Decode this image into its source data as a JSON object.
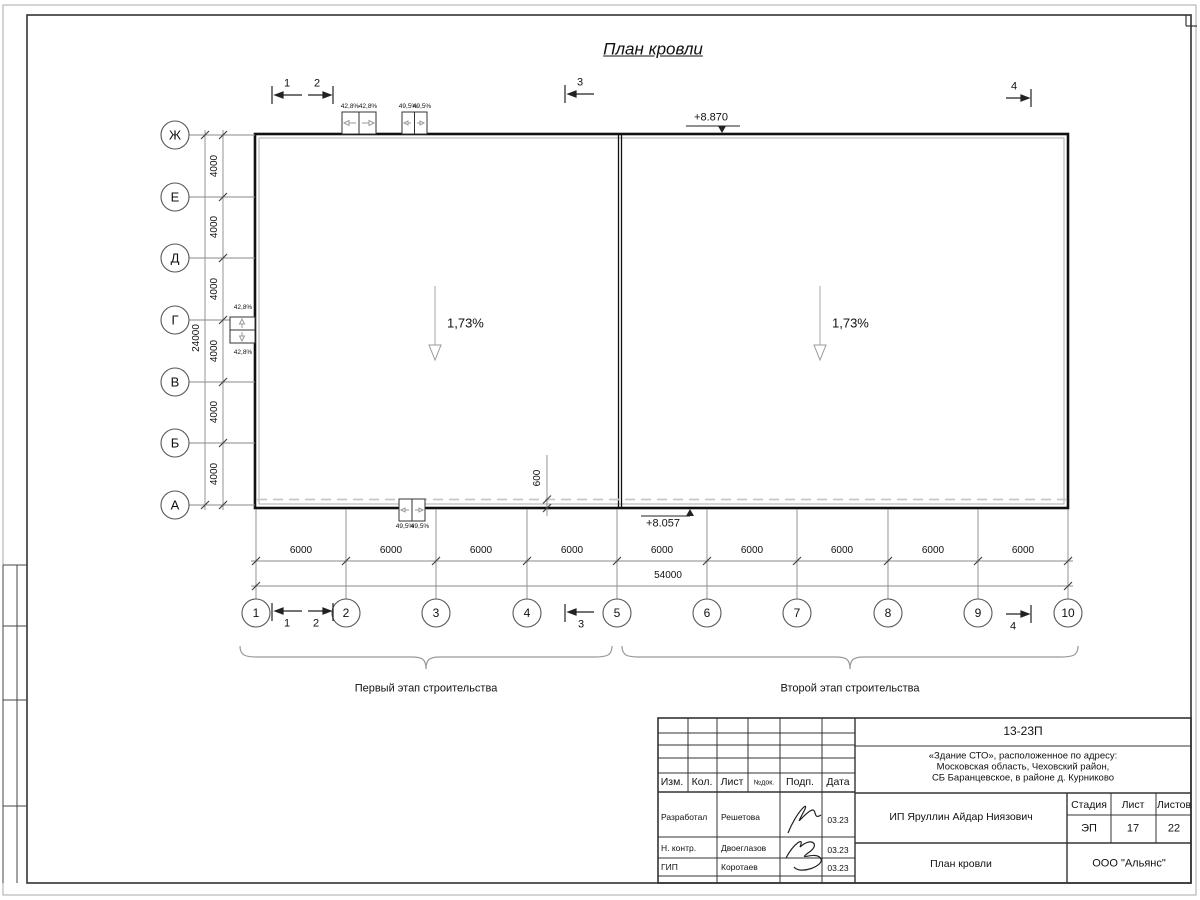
{
  "title": "План кровли",
  "colors": {
    "line": "#1a1a1a",
    "thin": "#888888",
    "dashed": "#c8c8c8"
  },
  "building": {
    "slope_left": "1,73%",
    "slope_right": "1,73%",
    "elev_top": "+8.870",
    "elev_bottom": "+8.057",
    "overhang_dim": "600",
    "hatch_top_a": [
      "42,8%",
      "42,8%"
    ],
    "hatch_top_b": [
      "49,5%",
      "49,5%"
    ],
    "hatch_bottom": [
      "49,5%",
      "49,5%"
    ],
    "hatch_left": [
      "42,8%",
      "42,8%"
    ]
  },
  "grid": {
    "rows": [
      "Ж",
      "Е",
      "Д",
      "Г",
      "В",
      "Б",
      "А"
    ],
    "cols": [
      "1",
      "2",
      "3",
      "4",
      "5",
      "6",
      "7",
      "8",
      "9",
      "10"
    ],
    "row_dims": [
      "4000",
      "4000",
      "4000",
      "4000",
      "4000",
      "4000"
    ],
    "row_total": "24000",
    "col_dims": [
      "6000",
      "6000",
      "6000",
      "6000",
      "6000",
      "6000",
      "6000",
      "6000",
      "6000"
    ],
    "col_total": "54000"
  },
  "sections": {
    "s1": "1",
    "s2": "2",
    "s3": "3",
    "s4": "4"
  },
  "stages": {
    "first": "Первый этап строительства",
    "second": "Второй этап строительства"
  },
  "titleblock": {
    "doc_code": "13-23П",
    "project_l1": "«Здание СТО», расположенное по адресу:",
    "project_l2": "Московская область, Чеховский район,",
    "project_l3": "СБ Баранцевское, в районе д. Курниково",
    "client": "ИП Яруллин Айдар Ниязович",
    "sheet_title": "План кровли",
    "org": "ООО \"Альянс\"",
    "headers": {
      "izm": "Изм.",
      "kol": "Кол.",
      "list": "Лист",
      "ndok": "№док.",
      "podp": "Подп.",
      "data": "Дата",
      "stadia": "Стадия",
      "list2": "Лист",
      "listov": "Листов"
    },
    "stadia_val": "ЭП",
    "list_val": "17",
    "listov_val": "22",
    "rows": [
      {
        "role": "Разработал",
        "name": "Решетова",
        "date": "03.23"
      },
      {
        "role": "Н. контр.",
        "name": "Двоеглазов",
        "date": "03.23"
      },
      {
        "role": "ГИП",
        "name": "Коротаев",
        "date": "03.23"
      }
    ]
  }
}
